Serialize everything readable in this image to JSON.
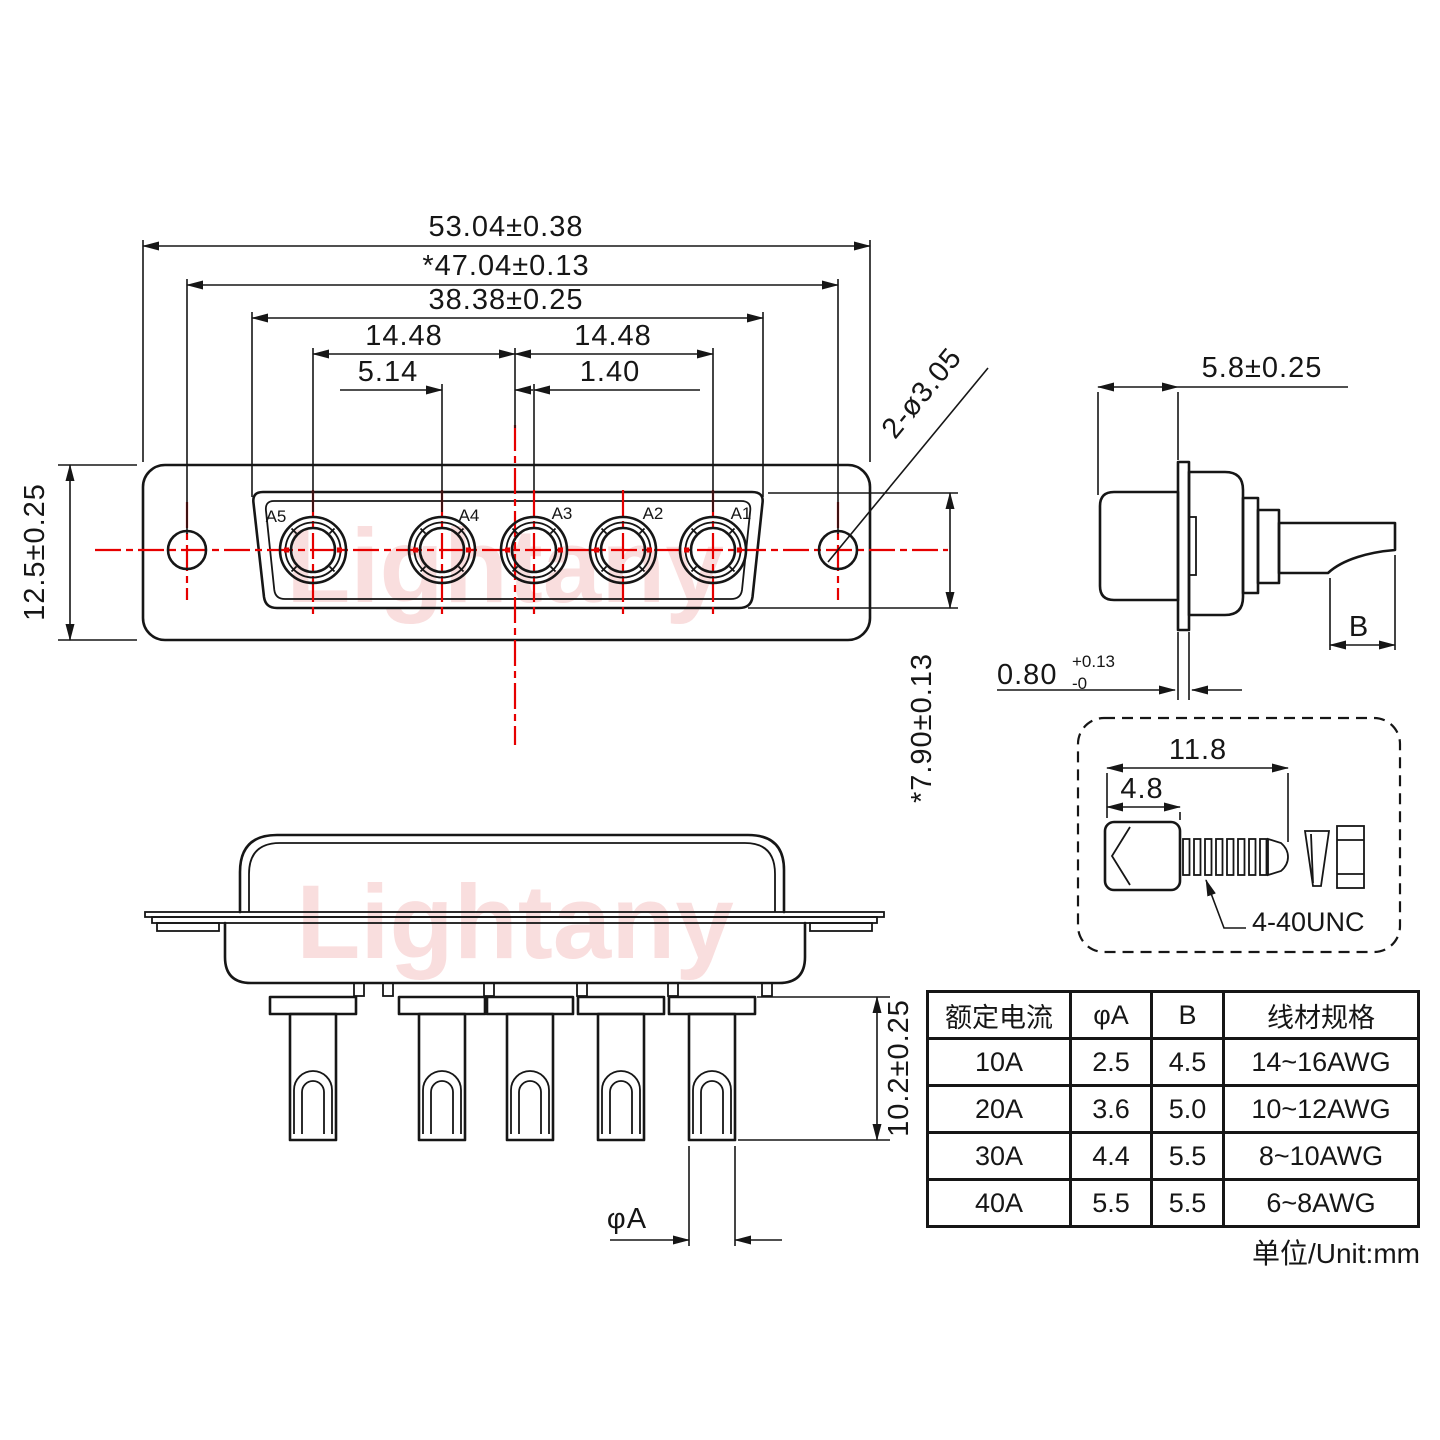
{
  "watermark": "Lightany",
  "front_view": {
    "contacts": [
      "A5",
      "A4",
      "A3",
      "A2",
      "A1"
    ],
    "dims": {
      "total_width": "53.04±0.38",
      "mount_width": "*47.04±0.13",
      "shell_width": "38.38±0.25",
      "pitch_left": "14.48",
      "pitch_right": "14.48",
      "a4_offset": "5.14",
      "a3_offset": "1.40",
      "body_height": "12.5±0.25",
      "shell_height": "*7.90±0.13",
      "mount_holes": "2-ø3.05"
    }
  },
  "side_view": {
    "dims": {
      "insert_depth": "5.8±0.25",
      "flange_thickness": "0.80",
      "flange_tol_plus": "+0.13",
      "flange_tol_minus": "-0",
      "barrel_label": "B"
    }
  },
  "bottom_view": {
    "dims": {
      "pin_length": "10.2±0.25",
      "pin_dia": "φA"
    }
  },
  "screw_detail": {
    "dims": {
      "overall": "11.8",
      "head": "4.8"
    },
    "thread": "4-40UNC"
  },
  "spec_table": {
    "headers": [
      "额定电流",
      "φA",
      "B",
      "线材规格"
    ],
    "rows": [
      [
        "10A",
        "2.5",
        "4.5",
        "14~16AWG"
      ],
      [
        "20A",
        "3.6",
        "5.0",
        "10~12AWG"
      ],
      [
        "30A",
        "4.4",
        "5.5",
        "8~10AWG"
      ],
      [
        "40A",
        "5.5",
        "5.5",
        "6~8AWG"
      ]
    ],
    "unit": "单位/Unit:mm"
  }
}
